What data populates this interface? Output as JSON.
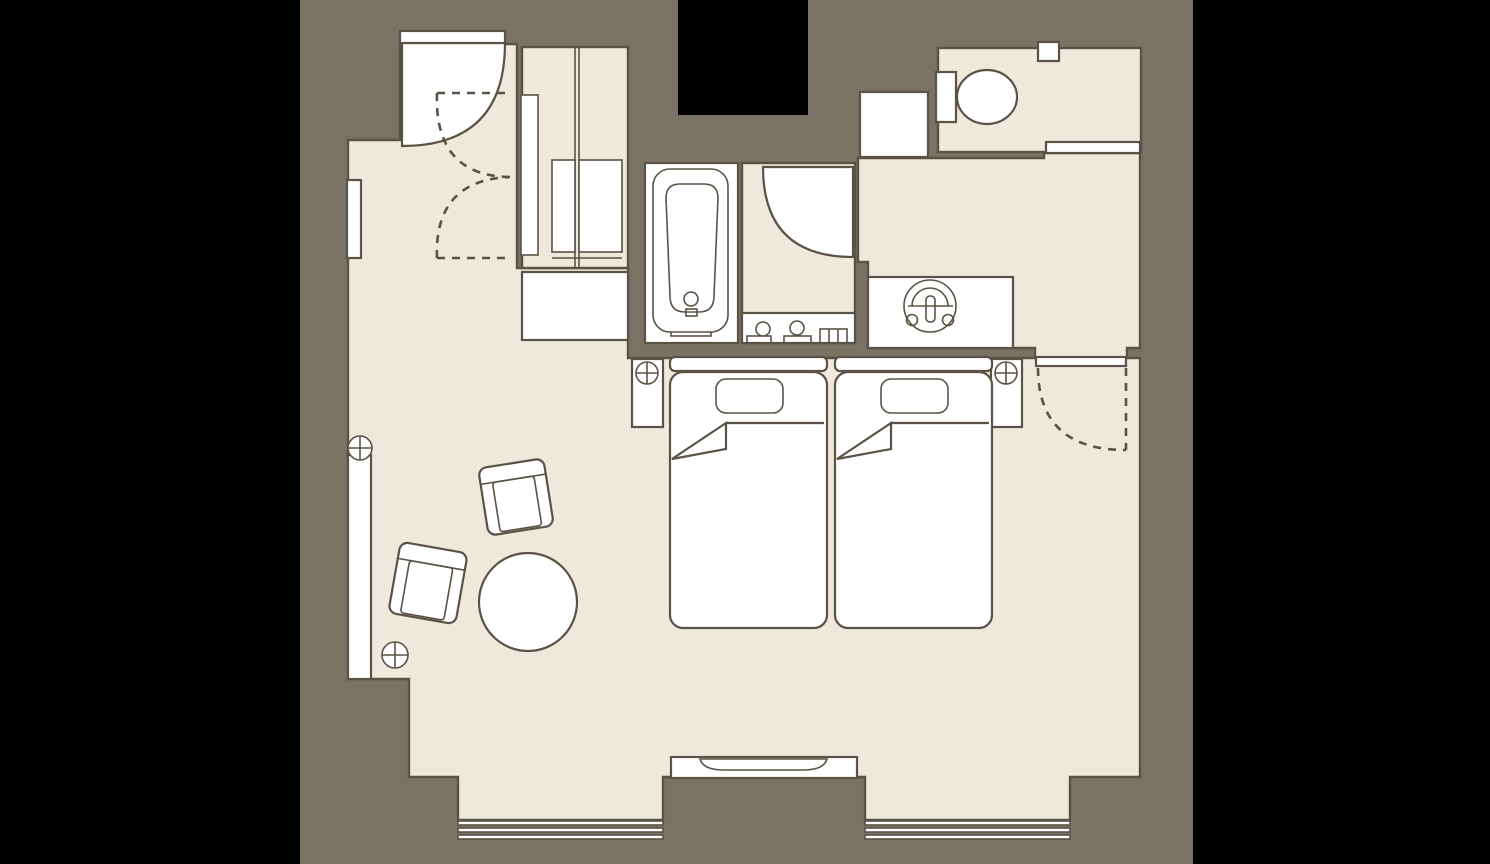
{
  "document": {
    "kind": "architectural floor plan",
    "subject": "hotel twin guest room plan view",
    "visible_text": "none"
  },
  "colors": {
    "black": "#000000",
    "bg": "#7a7365",
    "floor": "#edeadd",
    "white": "#ffffff",
    "line": "#5a5244"
  },
  "fixtures": [
    {
      "name": "entrance-door",
      "type": "hinged door with swing arc"
    },
    {
      "name": "entry-dashed-swings",
      "type": "dashed double door swing arcs"
    },
    {
      "name": "closet",
      "type": "wardrobe with double doors"
    },
    {
      "name": "luggage-bench",
      "type": "bench"
    },
    {
      "name": "bathtub",
      "type": "bathtub in bathroom"
    },
    {
      "name": "washroom-door",
      "type": "hinged door with swing arc"
    },
    {
      "name": "washroom-counter",
      "type": "counter with faucet fittings"
    },
    {
      "name": "vanity-counter",
      "type": "counter with round wash basin"
    },
    {
      "name": "toilet",
      "type": "toilet with tank"
    },
    {
      "name": "toilet-sliding-door",
      "type": "sliding door"
    },
    {
      "name": "bedroom-door",
      "type": "hinged door with dashed swing arc"
    },
    {
      "name": "bed-left",
      "type": "single bed with pillow and folded blanket"
    },
    {
      "name": "bed-right",
      "type": "single bed with pillow and folded blanket"
    },
    {
      "name": "nightstand-left",
      "type": "nightstand with lamp"
    },
    {
      "name": "nightstand-right",
      "type": "nightstand with lamp"
    },
    {
      "name": "armchair-upper",
      "type": "armchair"
    },
    {
      "name": "armchair-lower",
      "type": "armchair"
    },
    {
      "name": "round-table",
      "type": "round table"
    },
    {
      "name": "window-bench",
      "type": "window-side bench with floor lamps"
    },
    {
      "name": "tv-console",
      "type": "console with TV"
    },
    {
      "name": "window-left",
      "type": "triple-glazing window band"
    },
    {
      "name": "window-right",
      "type": "triple-glazing window band"
    },
    {
      "name": "service-shaft",
      "type": "shaft / duct space"
    },
    {
      "name": "wall-niche",
      "type": "wall niche"
    }
  ]
}
